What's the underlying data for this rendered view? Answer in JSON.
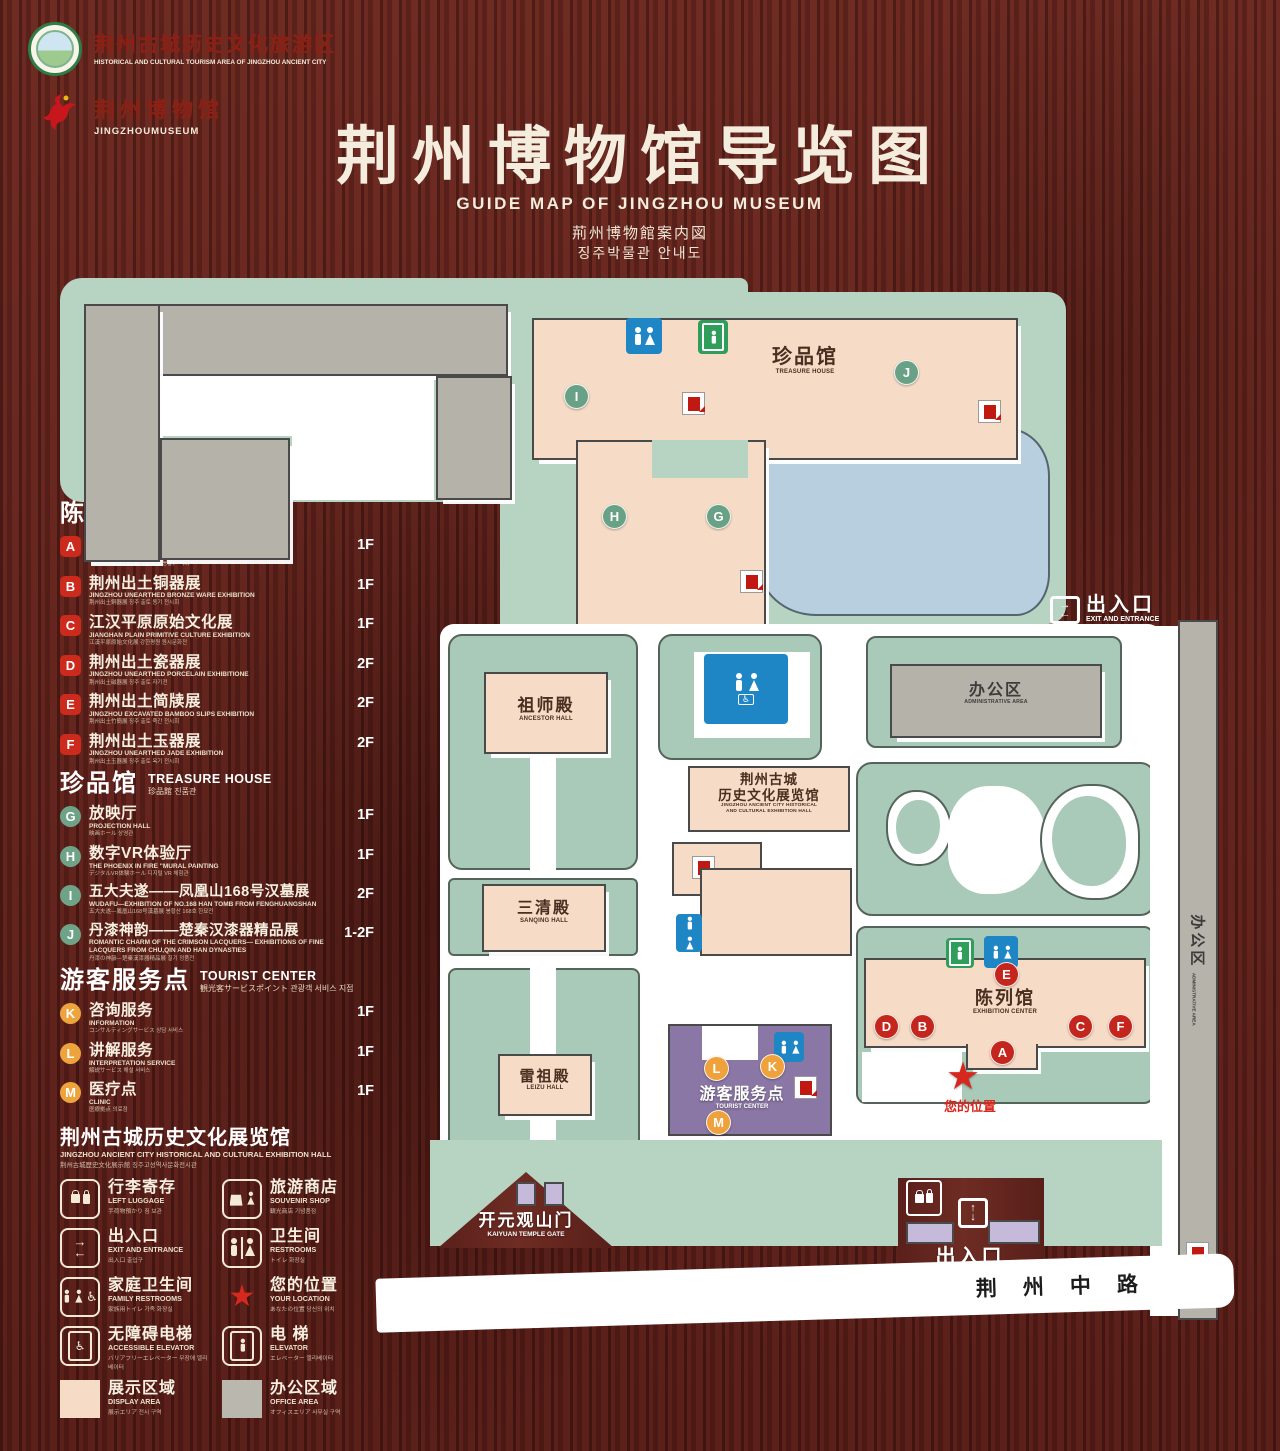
{
  "header": {
    "logo_tourism": {
      "zh": "荆州古城历史文化旅游区",
      "en": "HISTORICAL AND CULTURAL TOURISM AREA OF JINGZHOU ANCIENT CITY"
    },
    "logo_museum": {
      "zh": "荆州博物馆",
      "en": "JINGZHOUMUSEUM"
    },
    "title_zh": "荆州博物馆导览图",
    "title_en": "GUIDE MAP OF JINGZHOU MUSEUM",
    "title_ja": "荊州博物館案内図",
    "title_ko": "징주박물관 안내도"
  },
  "legend": {
    "exhibition": {
      "title_zh": "陈列馆",
      "title_en": "EXHIBITION CENTER",
      "title_sub": "陳列館  진열관",
      "items": [
        {
          "key": "A",
          "title": "《火中的凤凰》壁画",
          "en": "THE PHOENIX IN FIRE \"MURAL PAINTING",
          "sub": "「火中の鳳凰」壁画 《불속의 봉황》 벽화",
          "floor": "1F"
        },
        {
          "key": "B",
          "title": "荆州出土铜器展",
          "en": "JINGZHOU UNEARTHED BRONZE WARE EXHIBITION",
          "sub": "荆州出土銅器展  징주 출토 동기 전시회",
          "floor": "1F"
        },
        {
          "key": "C",
          "title": "江汉平原原始文化展",
          "en": "JIANGHAN PLAIN PRIMITIVE CULTURE EXHIBITION",
          "sub": "江漢平原原始文化展  강한평원 원시문화전",
          "floor": "1F"
        },
        {
          "key": "D",
          "title": "荆州出土瓷器展",
          "en": "JINGZHOU UNEARTHED PORCELAIN EXHIBITIONE",
          "sub": "荆州出土磁器展  징주 출토 자기전",
          "floor": "2F"
        },
        {
          "key": "E",
          "title": "荆州出土简牍展",
          "en": "JINGZHOU EXCAVATED BAMBOO SLIPS EXHIBITION",
          "sub": "荆州出土竹簡展  징주 출토 죽간 전시회",
          "floor": "2F"
        },
        {
          "key": "F",
          "title": "荆州出土玉器展",
          "en": "JINGZHOU UNEARTHED JADE EXHIBITION",
          "sub": "荆州出土玉器展  징주 출토 옥기 전시회",
          "floor": "2F"
        }
      ]
    },
    "treasure": {
      "title_zh": "珍品馆",
      "title_en": "TREASURE HOUSE",
      "title_sub": "珍品館  진품관",
      "items": [
        {
          "key": "G",
          "title": "放映厅",
          "en": "PROJECTION HALL",
          "sub": "映画ホール  상영관",
          "floor": "1F"
        },
        {
          "key": "H",
          "title": "数字VR体验厅",
          "en": "THE PHOENIX IN FIRE \"MURAL PAINTING",
          "sub": "デジタルVR体験ホール  디지털 VR 체험관",
          "floor": "1F"
        },
        {
          "key": "I",
          "title": "五大夫遂——凤凰山168号汉墓展",
          "en": "WUDAFU—EXHIBITION OF NO.168 HAN TOMB FROM FENGHUANGSHAN",
          "sub": "五大夫遂—鳳凰山168号漢墓展  봉황산 168호 한묘전",
          "floor": "2F"
        },
        {
          "key": "J",
          "title": "丹漆神韵——楚秦汉漆器精品展",
          "en": "ROMANTIC CHARM OF THE CRIMSON LACQUERS— EXHIBITIONS OF FINE LACQUERS FROM CHU,QIN AND HAN DYNASTIES",
          "sub": "丹漆の神韻—楚秦漢漆器精品展  칠기 정품전",
          "floor": "1-2F"
        }
      ]
    },
    "tourist": {
      "title_zh": "游客服务点",
      "title_en": "TOURIST CENTER",
      "title_sub": "観光客サービスポイント  관광객 서비스 지점",
      "items": [
        {
          "key": "K",
          "title": "咨询服务",
          "en": "INFORMATION",
          "sub": "コンサルティングサービス  상담 서비스",
          "floor": "1F"
        },
        {
          "key": "L",
          "title": "讲解服务",
          "en": "INTERPRETATION SERVICE",
          "sub": "解説サービス  해설 서비스",
          "floor": "1F"
        },
        {
          "key": "M",
          "title": "医疗点",
          "en": "CLINIC",
          "sub": "医療拠点  의료점",
          "floor": "1F"
        }
      ]
    },
    "hall_note": {
      "zh": "荆州古城历史文化展览馆",
      "en": "JINGZHOU ANCIENT CITY HISTORICAL AND CULTURAL EXHIBITION HALL",
      "sub": "荆州古城歴史文化展示館    징주고성역사문화전시관"
    },
    "facilities": [
      {
        "icon": "luggage-icon",
        "zh": "行李寄存",
        "en": "LEFT LUGGAGE",
        "sub": "手荷物預かり  짐 보관"
      },
      {
        "icon": "souvenir-shop-icon",
        "zh": "旅游商店",
        "en": "SOUVENIR SHOP",
        "sub": "観光商店  기념품점"
      },
      {
        "icon": "exit-entrance-icon",
        "zh": "出入口",
        "en": "EXIT AND ENTRANCE",
        "sub": "出入口  출입구"
      },
      {
        "icon": "restrooms-icon",
        "zh": "卫生间",
        "en": "RESTROOMS",
        "sub": "トイレ  화장실"
      },
      {
        "icon": "family-restrooms-icon",
        "zh": "家庭卫生间",
        "en": "FAMILY RESTROOMS",
        "sub": "家族用トイレ  가족 화장실"
      },
      {
        "icon": "your-location-star-icon",
        "zh": "您的位置",
        "en": "YOUR LOCATION",
        "sub": "あなたの位置  당신의 위치"
      },
      {
        "icon": "accessible-elevator-icon",
        "zh": "无障碍电梯",
        "en": "ACCESSIBLE ELEVATOR",
        "sub": "バリアフリーエレベーター  무장애 엘리베이터"
      },
      {
        "icon": "elevator-icon",
        "zh": "电  梯",
        "en": "ELEVATOR",
        "sub": "エレベーター  엘리베이터"
      },
      {
        "icon": "display-area-swatch",
        "zh": "展示区域",
        "en": "DISPLAY AREA",
        "sub": "展示エリア  전시 구역"
      },
      {
        "icon": "office-area-swatch",
        "zh": "办公区域",
        "en": "OFFICE AREA",
        "sub": "オフィスエリア  사무실 구역"
      }
    ]
  },
  "map": {
    "labels": {
      "admin_top": {
        "zh": "办公区",
        "en": "ADMINISTRATIVE AREA"
      },
      "treasure": {
        "zh": "珍品馆",
        "en": "TREASURE HOUSE"
      },
      "entrance_right": {
        "zh": "出入口",
        "en": "EXIT AND ENTRANCE"
      },
      "admin_right": {
        "zh": "办公区",
        "en": "ADMINISTRATIVE AREA"
      },
      "ancestor": {
        "zh": "祖师殿",
        "en": "ANCESTOR HALL"
      },
      "history_hall": {
        "zh1": "荆州古城",
        "zh2": "历史文化展览馆",
        "en1": "JINGZHOU ANCIENT CITY HISTORICAL",
        "en2": "AND CULTURAL EXHIBITION HALL"
      },
      "sanqing": {
        "zh": "三清殿",
        "en": "SANQING HALL"
      },
      "leizu": {
        "zh": "雷祖殿",
        "en": "LEIZU HALL"
      },
      "tourist": {
        "zh": "游客服务点",
        "en": "TOURIST CENTER"
      },
      "exhibition": {
        "zh": "陈列馆",
        "en": "EXHIBITION CENTER"
      },
      "your_location": {
        "zh": "您的位置"
      },
      "admin_strip": {
        "zh": "办公区",
        "en": "ADMINISTRATIVE AREA"
      },
      "kaiyuan_gate": {
        "zh": "开元观山门",
        "en": "KAIYUAN TEMPLE GATE"
      },
      "entrance_bottom": {
        "zh": "出入口",
        "en": "EXIT AND ENTRANCE"
      },
      "road": {
        "zh": "荆州中路"
      }
    },
    "marker_letters": [
      "A",
      "B",
      "C",
      "D",
      "E",
      "F",
      "G",
      "H",
      "I",
      "J",
      "K",
      "L",
      "M"
    ]
  },
  "colors": {
    "wood": "#5c211b",
    "mint": "#b7d4c3",
    "display_pink": "#f6dcc6",
    "office_gray": "#b4b2a9",
    "lake_blue": "#b7cfdf",
    "tourist_purple": "#8b77a5",
    "gate_purple": "#c6bada",
    "marker_red": "#c4251c",
    "marker_green": "#68a186",
    "marker_orange": "#efa23b",
    "restroom_blue": "#1f86c5",
    "elevator_green": "#2f9e5b",
    "star_red": "#d6281e"
  }
}
